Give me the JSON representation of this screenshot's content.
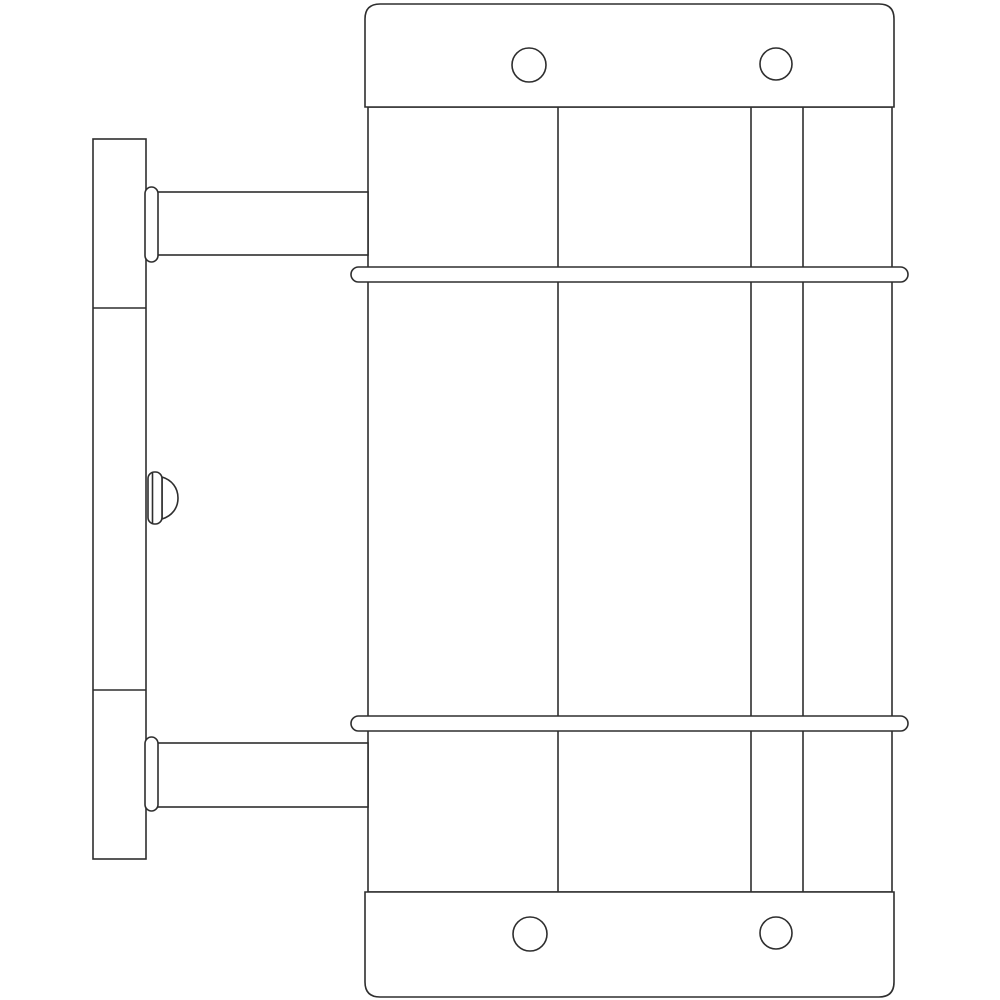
{
  "drawing": {
    "title": "wall-mounted-cylindrical-fixture-side-view",
    "canvas": {
      "width": 1000,
      "height": 1000
    },
    "style": {
      "background": "#ffffff",
      "stroke_color": "#2e2e2e",
      "fill_color": "#ffffff",
      "stroke_width": 1.6
    },
    "shapes": [
      {
        "name": "body-outline",
        "tag": "rect",
        "fill": "#ffffff",
        "attrs": {
          "x": 368,
          "y": 107,
          "width": 524,
          "height": 785
        }
      },
      {
        "name": "body-seam-line-left",
        "tag": "line",
        "fill": "none",
        "attrs": {
          "x1": 558,
          "y1": 107,
          "x2": 558,
          "y2": 892
        }
      },
      {
        "name": "body-seam-line-mid",
        "tag": "line",
        "fill": "none",
        "attrs": {
          "x1": 751,
          "y1": 107,
          "x2": 751,
          "y2": 892
        }
      },
      {
        "name": "body-seam-line-right",
        "tag": "line",
        "fill": "none",
        "attrs": {
          "x1": 803,
          "y1": 107,
          "x2": 803,
          "y2": 892
        }
      },
      {
        "name": "top-cap",
        "tag": "path",
        "fill": "#ffffff",
        "attrs": {
          "d": "M 365 107 L 365 19 Q 365 4 380 4 L 879 4 Q 894 4 894 19 L 894 107 Z"
        }
      },
      {
        "name": "top-screw-hole-left",
        "tag": "circle",
        "fill": "#ffffff",
        "attrs": {
          "cx": 529,
          "cy": 65,
          "r": 17
        }
      },
      {
        "name": "top-screw-hole-right",
        "tag": "circle",
        "fill": "#ffffff",
        "attrs": {
          "cx": 776,
          "cy": 64,
          "r": 16
        }
      },
      {
        "name": "bottom-cap",
        "tag": "path",
        "fill": "#ffffff",
        "attrs": {
          "d": "M 365 892 L 894 892 L 894 982 Q 894 997 879 997 L 380 997 Q 365 997 365 982 Z"
        }
      },
      {
        "name": "bottom-screw-hole-left",
        "tag": "circle",
        "fill": "#ffffff",
        "attrs": {
          "cx": 530,
          "cy": 934,
          "r": 17
        }
      },
      {
        "name": "bottom-screw-hole-right",
        "tag": "circle",
        "fill": "#ffffff",
        "attrs": {
          "cx": 776,
          "cy": 933,
          "r": 16
        }
      },
      {
        "name": "wall-plate",
        "tag": "rect",
        "fill": "#ffffff",
        "attrs": {
          "x": 93,
          "y": 139,
          "width": 53,
          "height": 720
        }
      },
      {
        "name": "wall-plate-seam-top",
        "tag": "line",
        "fill": "none",
        "attrs": {
          "x1": 93,
          "y1": 308,
          "x2": 146,
          "y2": 308
        }
      },
      {
        "name": "wall-plate-seam-bottom",
        "tag": "line",
        "fill": "none",
        "attrs": {
          "x1": 93,
          "y1": 690,
          "x2": 146,
          "y2": 690
        }
      },
      {
        "name": "upper-arm",
        "tag": "rect",
        "fill": "#ffffff",
        "attrs": {
          "x": 146,
          "y": 192,
          "width": 222,
          "height": 63
        }
      },
      {
        "name": "upper-arm-collar",
        "tag": "rect",
        "fill": "#ffffff",
        "attrs": {
          "x": 145,
          "y": 187,
          "width": 13,
          "height": 75,
          "rx": 6.5
        }
      },
      {
        "name": "lower-arm",
        "tag": "rect",
        "fill": "#ffffff",
        "attrs": {
          "x": 146,
          "y": 743,
          "width": 222,
          "height": 64
        }
      },
      {
        "name": "lower-arm-collar",
        "tag": "rect",
        "fill": "#ffffff",
        "attrs": {
          "x": 145,
          "y": 737,
          "width": 13,
          "height": 74,
          "rx": 6.5
        }
      },
      {
        "name": "knob-dome",
        "tag": "path",
        "fill": "#ffffff",
        "attrs": {
          "d": "M 162 477 C 172 480 178 488 178 498 C 178 508 172 516 162 519 Z"
        }
      },
      {
        "name": "knob-base",
        "tag": "rect",
        "fill": "#ffffff",
        "attrs": {
          "x": 148,
          "y": 472,
          "width": 14,
          "height": 52,
          "rx": 6.5
        }
      },
      {
        "name": "knob-face-line",
        "tag": "line",
        "fill": "none",
        "attrs": {
          "x1": 152.5,
          "y1": 473,
          "x2": 152.5,
          "y2": 523
        }
      },
      {
        "name": "upper-retaining-band",
        "tag": "rect",
        "fill": "#ffffff",
        "attrs": {
          "x": 351,
          "y": 267,
          "width": 557,
          "height": 15,
          "rx": 7.5
        }
      },
      {
        "name": "lower-retaining-band",
        "tag": "rect",
        "fill": "#ffffff",
        "attrs": {
          "x": 351,
          "y": 716,
          "width": 557,
          "height": 15,
          "rx": 7.5
        }
      }
    ]
  }
}
